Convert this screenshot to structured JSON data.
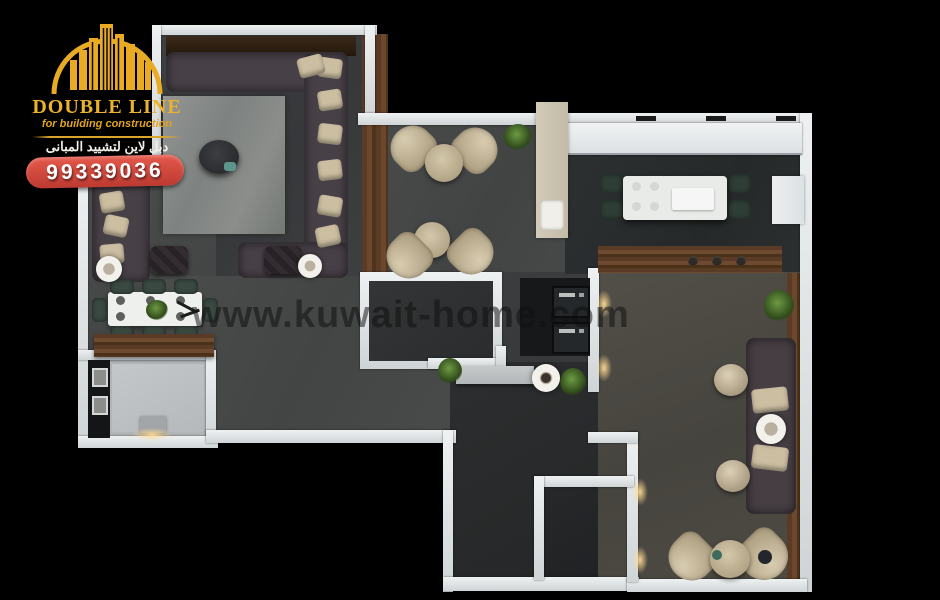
{
  "canvas": {
    "background": "#000000",
    "width": 940,
    "height": 600
  },
  "brand": {
    "name": "DOUBLE LINE",
    "tagline": "for building construction",
    "arabic_name": "دبل لاين لتشييد المبانى",
    "phone": "99339036",
    "colors": {
      "gold": "#E9B02A",
      "badge_red": "#D4453C",
      "text_white": "#F2EFE6"
    }
  },
  "watermark": {
    "text": "www.kuwait-home.com",
    "color": "#0E1010"
  }
}
